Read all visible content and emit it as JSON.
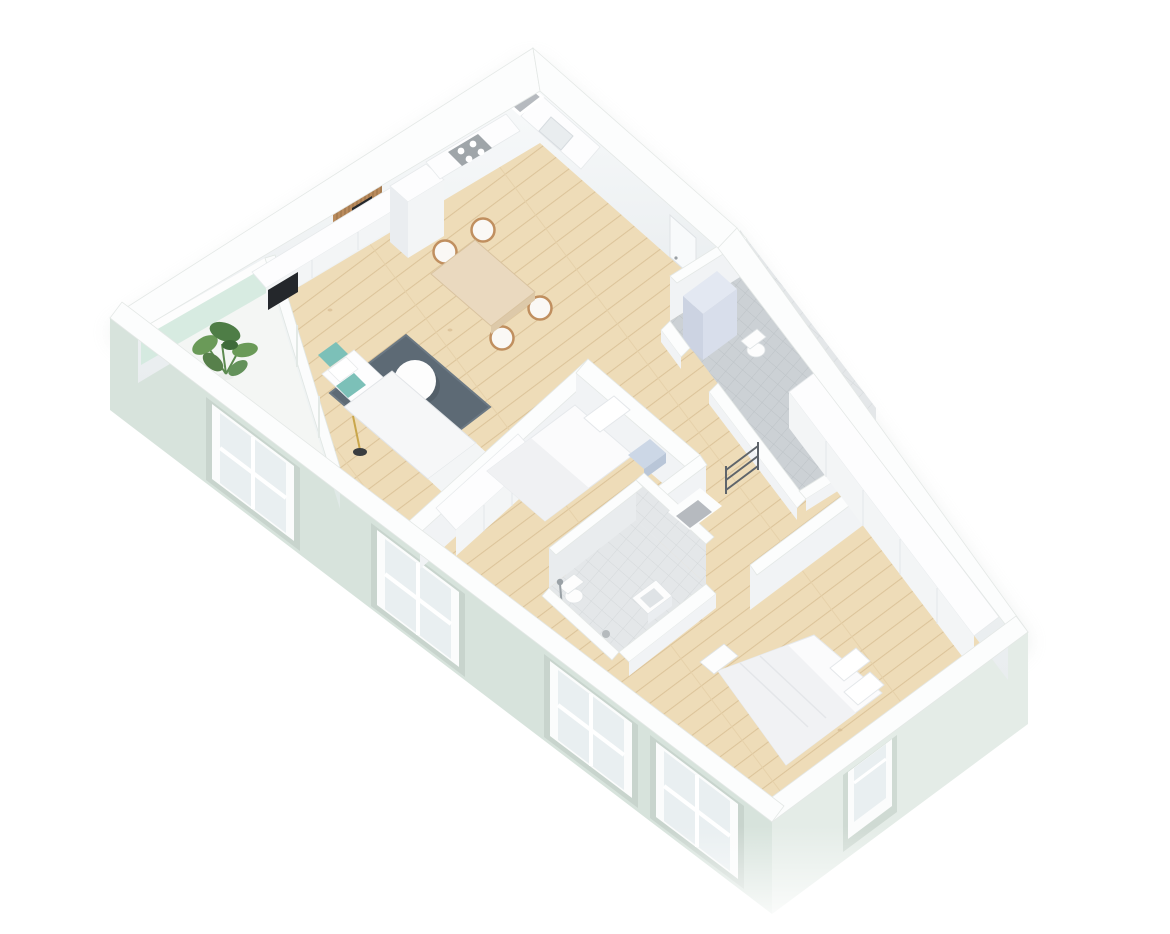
{
  "scene": {
    "kind": "isometric 3D floor-plan rendering",
    "style": "dollhouse cutaway of a two-bedroom apartment, viewed from above at an angle",
    "background": "#ffffff",
    "plan_shape": "wedge/trapezoid, long axis running from upper-left to lower-right",
    "windows": {
      "southwest_wall": 4,
      "southeast_wall": 1
    }
  },
  "palette": {
    "wood": "#eedcb8",
    "wood_line": "#dcc49a",
    "wood_joint": "#e6d1aa",
    "tile": "#ccd1d5",
    "tile_line": "#bdc3c7",
    "tile_wall": "#e4e7e9",
    "wall_top": "#fcfdfd",
    "wall_face": "#f1f3f5",
    "exterior_sw": "#d7e3dc",
    "exterior_se": "#e4ece7",
    "window_recess": "#c8d4cd",
    "window_glass": "#e9eff1",
    "balcony_glass": "#cfe9dc",
    "rug": "#5d6a75",
    "sofa": "#f6f7f8",
    "accent_teal": "#7cc0b8",
    "dining_table": "#ead9bf",
    "chair_wood": "#c08f5f",
    "slat_wood": "#b98a5c",
    "slat_gap": "#8f6a42",
    "stove": "#9fa5a9",
    "tv": "#24272b",
    "nightstand": "#ccd7e6",
    "washer": "#e3e8f2",
    "lamp_gold": "#c9a64b",
    "plant_dark": "#4e7d46",
    "plant_light": "#6a9a58",
    "shadow": "#b9c2bd",
    "niche_floor": "#b6babf"
  },
  "rooms": [
    {
      "id": "living-kitchen",
      "floor": "wood planks",
      "objects": [
        "kitchen counter with cooktop",
        "kitchen sink counter",
        "tall cabinet",
        "wood-slat media wall",
        "low sideboard with TV",
        "dining table",
        "4 chairs",
        "dark rug",
        "round coffee table",
        "corner sofa with pillows",
        "floor lamp"
      ]
    },
    {
      "id": "balcony",
      "floor": "concrete white",
      "objects": [
        "green plant",
        "glass balustrade",
        "glazed facade wall"
      ]
    },
    {
      "id": "bedroom-middle",
      "floor": "wood planks",
      "objects": [
        "single bed",
        "wardrobe",
        "blue nightstand"
      ]
    },
    {
      "id": "bathroom-long",
      "floor": "grey mosaic tiles",
      "objects": [
        "washing machine box",
        "wash basin",
        "toilet"
      ]
    },
    {
      "id": "bathroom-small",
      "floor": "grey tiles",
      "objects": [
        "shower with drain",
        "wash basin",
        "toilet"
      ]
    },
    {
      "id": "bedroom-master",
      "floor": "wood planks",
      "objects": [
        "double bed with white duvet and pillows",
        "long white wardrobe",
        "bench"
      ]
    },
    {
      "id": "hallway",
      "floor": "wood planks",
      "objects": [
        "towel radiator",
        "entrance door",
        "utility shafts"
      ]
    }
  ]
}
